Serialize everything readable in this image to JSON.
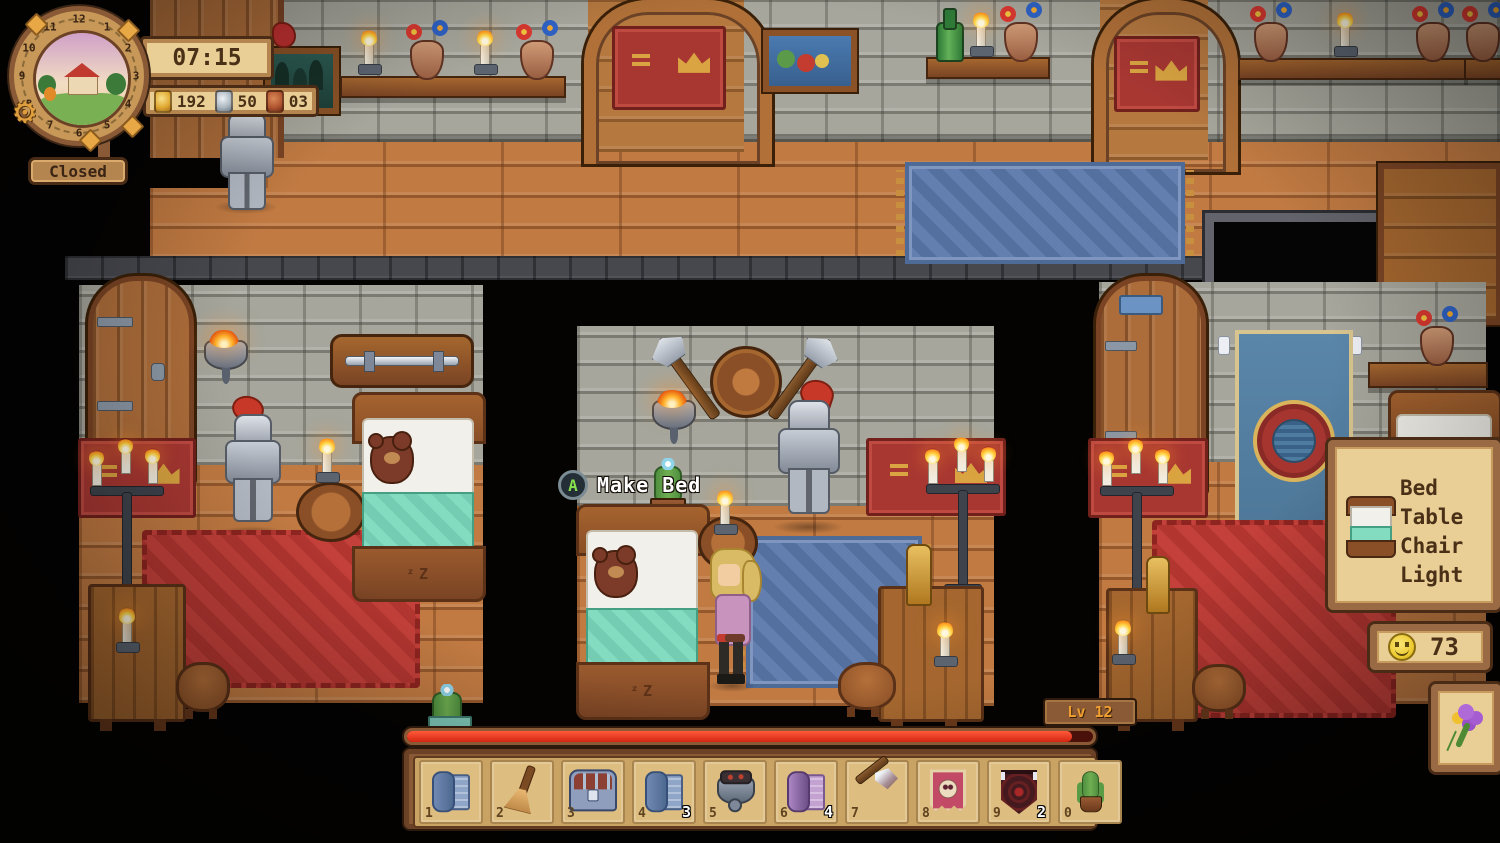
{
  "colors": {
    "accent_red": "#e03020",
    "panel_tan": "#e9cf96",
    "frame_brown": "#8a5a36",
    "text_brown": "#4a3016",
    "level_text": "#f0a030"
  },
  "icons": {
    "gear": "⚙"
  },
  "hud": {
    "clock": {
      "numbers": [
        "12",
        "1",
        "2",
        "3",
        "4",
        "5",
        "6",
        "7",
        "8",
        "9",
        "10",
        "11"
      ]
    },
    "time": "07:15",
    "status": "Closed",
    "currency": {
      "gold": "192",
      "silver": "50",
      "copper": "03"
    },
    "interaction": {
      "button": "A",
      "label": "Make Bed"
    },
    "level": "Lv 12"
  },
  "xp": {
    "percent": 97
  },
  "build_panel": {
    "items": [
      "Bed",
      "Table",
      "Chair",
      "Light"
    ]
  },
  "happiness": {
    "value": "73"
  },
  "hotbar": {
    "slots": [
      {
        "key": "1",
        "item": "blueprint-roll-blue",
        "count": ""
      },
      {
        "key": "2",
        "item": "broom",
        "count": ""
      },
      {
        "key": "3",
        "item": "storage-chest",
        "count": ""
      },
      {
        "key": "4",
        "item": "blueprint-roll-blue",
        "count": "3"
      },
      {
        "key": "5",
        "item": "cauldron",
        "count": ""
      },
      {
        "key": "6",
        "item": "blueprint-roll-purple",
        "count": "4"
      },
      {
        "key": "7",
        "item": "hand-axe",
        "count": ""
      },
      {
        "key": "8",
        "item": "banner-pink",
        "count": ""
      },
      {
        "key": "9",
        "item": "banner-dark",
        "count": "2"
      },
      {
        "key": "0",
        "item": "potted-cactus",
        "count": ""
      }
    ]
  }
}
